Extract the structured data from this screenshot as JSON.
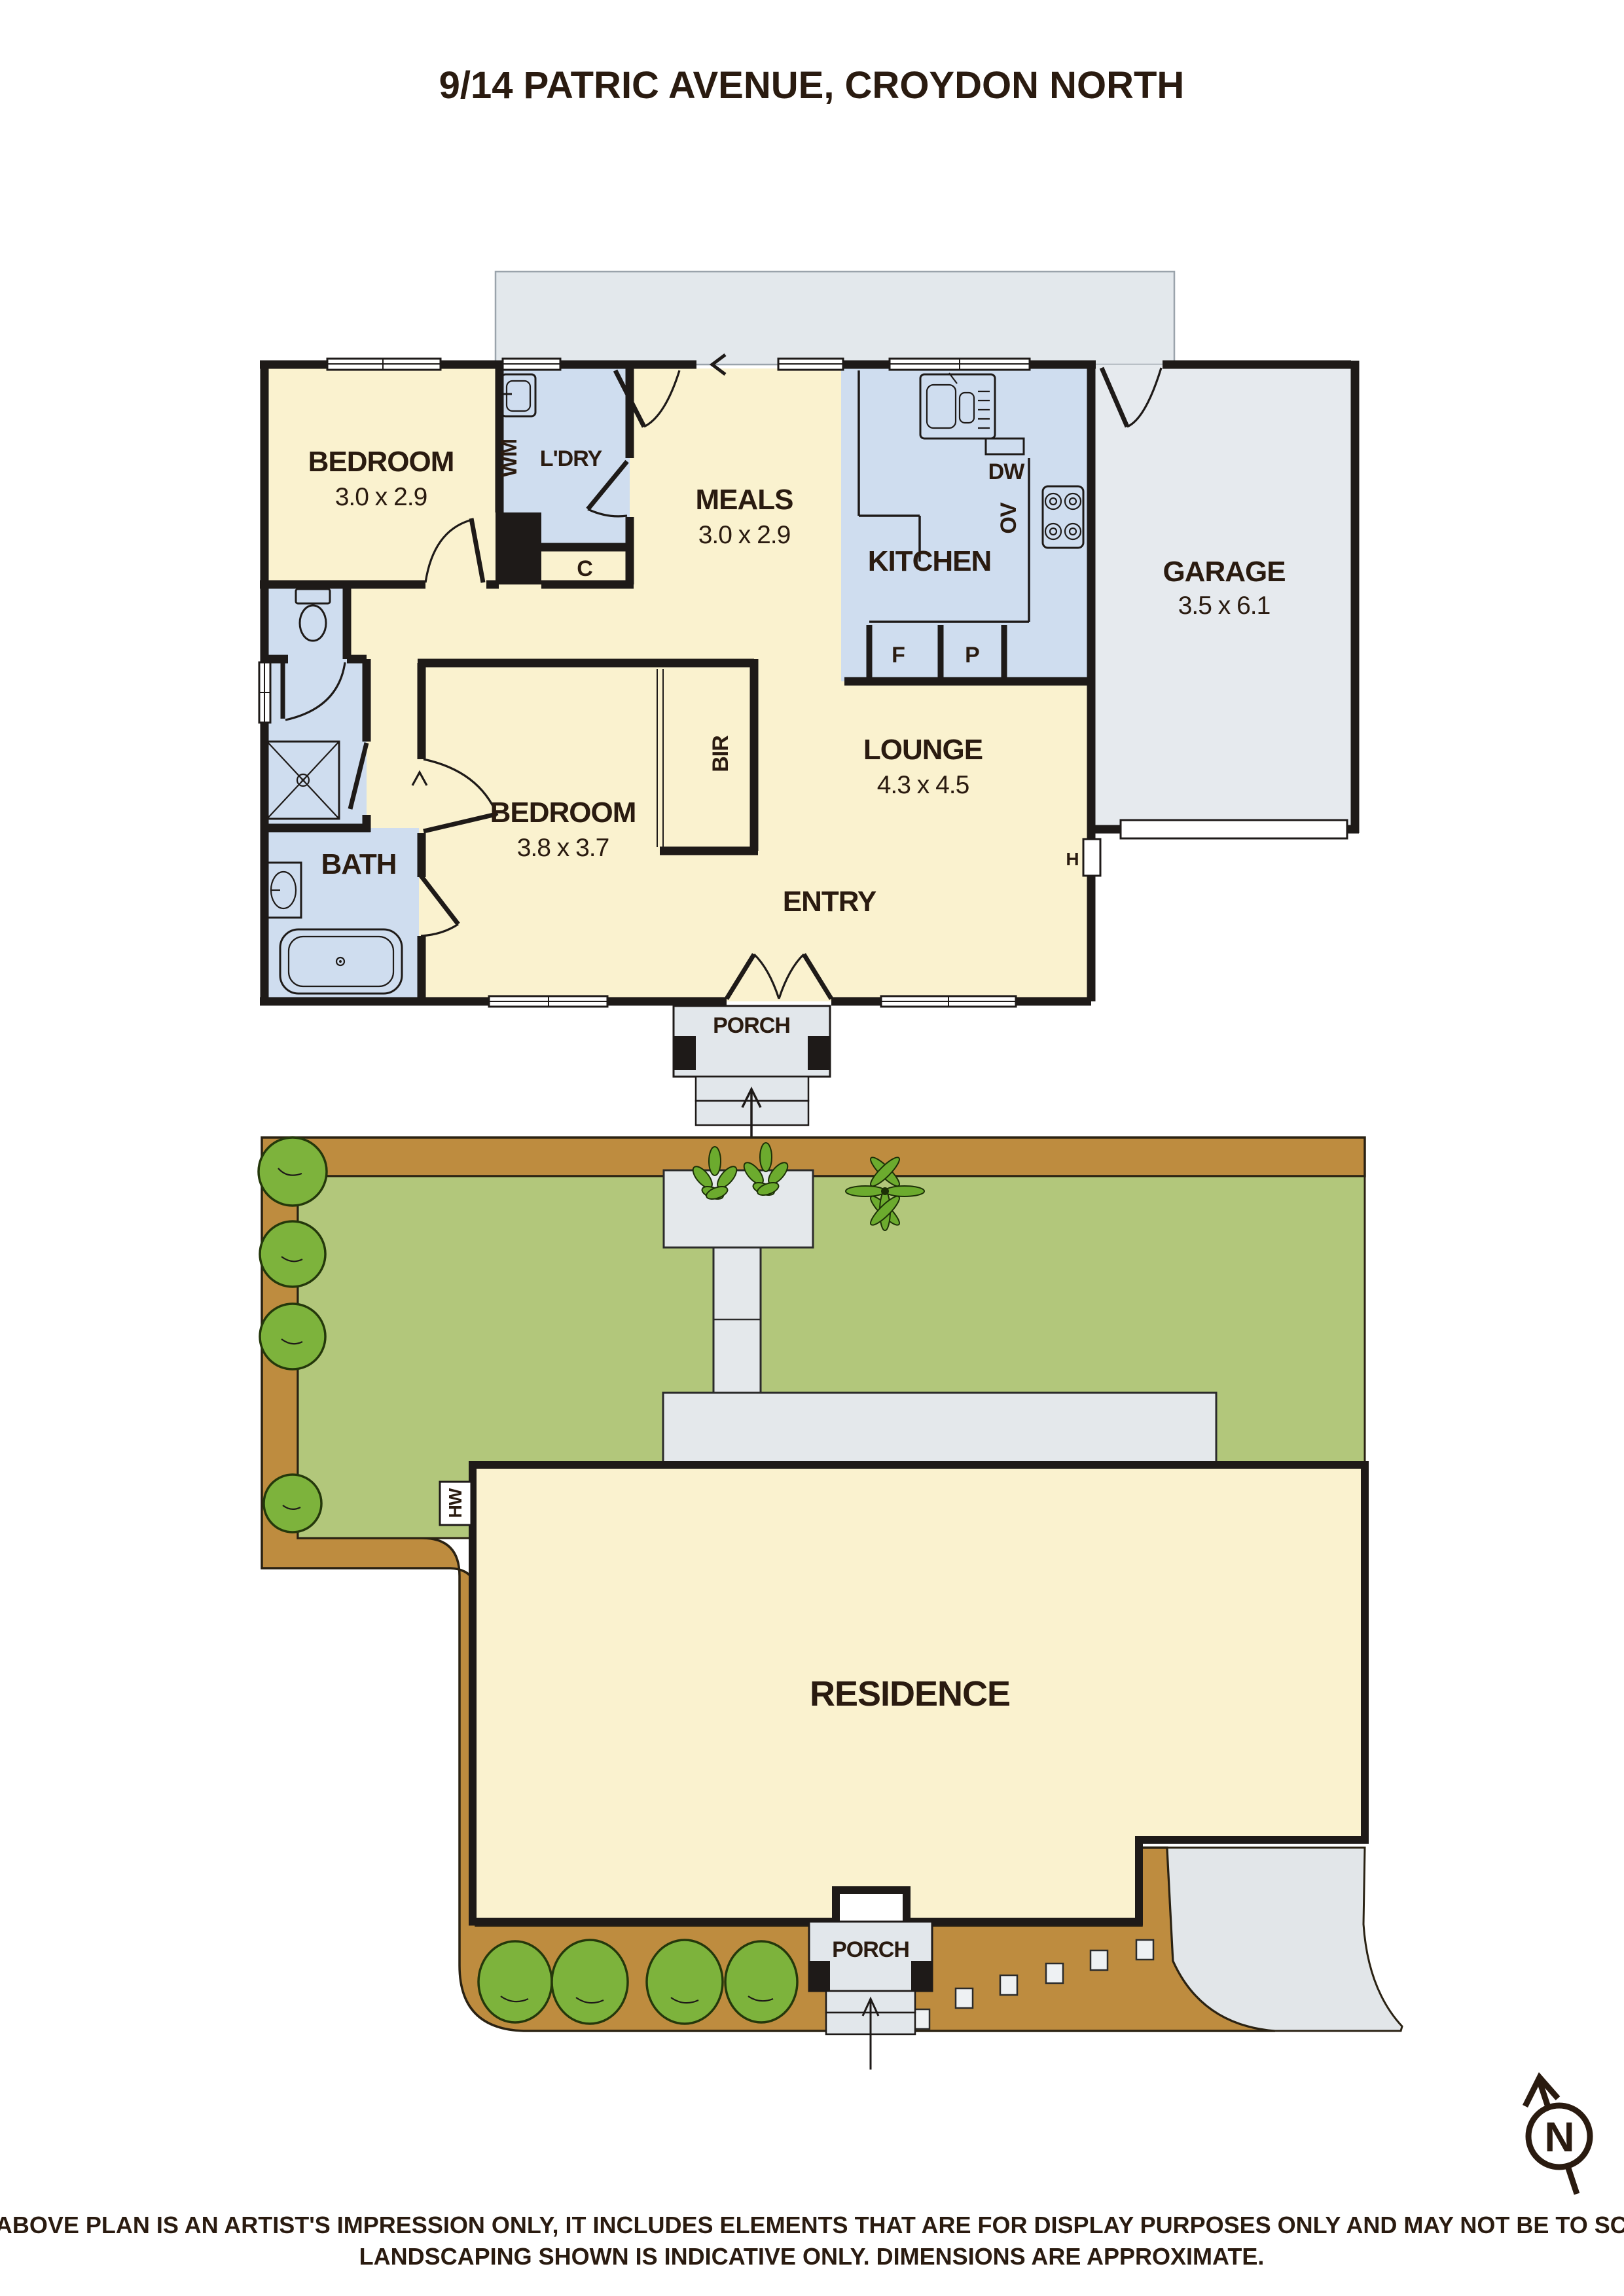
{
  "title": "9/14 PATRIC AVENUE, CROYDON NORTH",
  "floor_plan": {
    "bedroom1": {
      "name": "BEDROOM",
      "dims": "3.0 x 2.9"
    },
    "laundry": {
      "name": "L'DRY",
      "washing_machine": "WM",
      "cupboard": "C"
    },
    "meals": {
      "name": "MEALS",
      "dims": "3.0 x 2.9"
    },
    "kitchen": {
      "name": "KITCHEN",
      "dishwasher": "DW",
      "oven": "OV",
      "fridge": "F",
      "pantry": "P"
    },
    "garage": {
      "name": "GARAGE",
      "dims": "3.5 x 6.1"
    },
    "bedroom2": {
      "name": "BEDROOM",
      "dims": "3.8 x 3.7"
    },
    "bath": {
      "name": "BATH"
    },
    "robe": "BIR",
    "lounge": {
      "name": "LOUNGE",
      "dims": "4.3 x 4.5"
    },
    "entry": "ENTRY",
    "porch": "PORCH",
    "hot_water": "H"
  },
  "site_plan": {
    "residence": "RESIDENCE",
    "porch": "PORCH",
    "hot_water": "HW"
  },
  "compass": {
    "north": "N"
  },
  "disclaimer": {
    "line1": "THE ABOVE PLAN IS AN ARTIST'S IMPRESSION ONLY, IT INCLUDES ELEMENTS THAT ARE FOR DISPLAY PURPOSES ONLY AND MAY NOT BE TO SCALE.",
    "line2": "LANDSCAPING SHOWN IS INDICATIVE ONLY. DIMENSIONS ARE APPROXIMATE."
  },
  "colors": {
    "wall": "#1E1A18",
    "room_cream": "#FAF2CF",
    "wet_blue": "#CFDDEF",
    "garage_gray": "#E6EAEE",
    "eave_gray": "#E3E8EC",
    "path_brown": "#BE8C3F",
    "lawn_green": "#B2C77B",
    "foliage_green": "#7DB33C",
    "driveway_gray": "#E2E6E9",
    "text_dark": "#2A1B10"
  }
}
